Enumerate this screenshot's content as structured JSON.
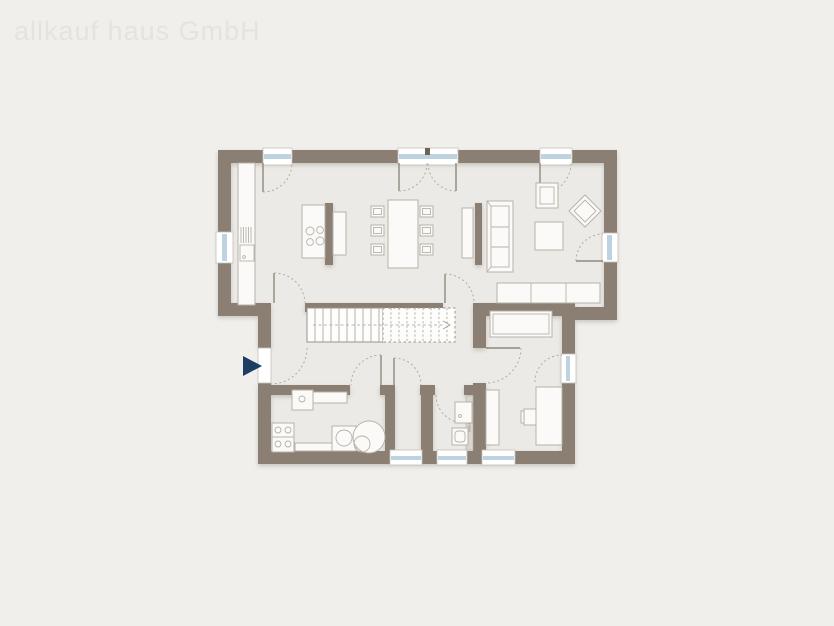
{
  "watermark": "allkauf haus GmbH",
  "labels": {
    "shower": "Dusche"
  },
  "colors": {
    "background": "#f0efec",
    "floor": "#eceae6",
    "wall": "#8a7f72",
    "furniture_fill": "#fbfaf8",
    "furniture_stroke": "#b7b2a9",
    "glass": "#bdd3e1",
    "frame_stroke": "#c7c2ba",
    "arc": "#b2aba0",
    "stair_line": "#a59f96",
    "leaf": "#8f897d",
    "arrow": "#1d3d63",
    "watermark": "#e4e3e0"
  },
  "symbols": {
    "entrance_arrow": "navy triangle pointing right at entrance door",
    "windows": [
      "top-left",
      "top-center-double-door",
      "top-right",
      "left-wall",
      "right-wall-terrace",
      "bedroom-right",
      "bottom-storage",
      "bottom-bath",
      "bottom-bedroom"
    ],
    "furniture": [
      "kitchen-counter-sink",
      "kitchen-island-cooktop",
      "dining-table-6-chairs",
      "tv-lowboard",
      "sofa-3-seat",
      "armchair",
      "lounge-chair-diamond",
      "coffee-table",
      "sideboard",
      "stairs",
      "bed",
      "wardrobe",
      "desk-with-chair",
      "laundry-sink",
      "washer-dryer-stack",
      "washing-machine",
      "boiler-tank",
      "shower-screen",
      "bath-sink",
      "toilet"
    ]
  }
}
